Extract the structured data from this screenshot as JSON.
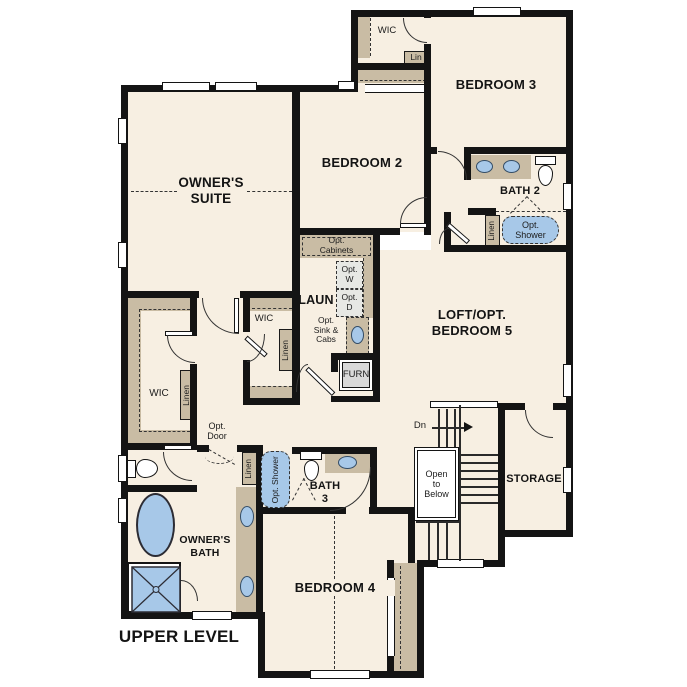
{
  "title": "UPPER LEVEL",
  "rooms": {
    "owners_suite": {
      "l1": "OWNER'S",
      "l2": "SUITE"
    },
    "bedroom2": "BEDROOM 2",
    "bedroom3": "BEDROOM 3",
    "bedroom4": "BEDROOM 4",
    "bedroom5_loft": {
      "l1": "LOFT/OPT.",
      "l2": "BEDROOM 5"
    },
    "bath2": "BATH 2",
    "bath3": {
      "l1": "BATH",
      "l2": "3"
    },
    "owners_bath": {
      "l1": "OWNER'S",
      "l2": "BATH"
    },
    "laundry": "LAUN",
    "storage": "STORAGE"
  },
  "closets": {
    "wic": "WIC",
    "lin": "Lin",
    "linen": "Linen"
  },
  "options": {
    "cabinets": {
      "l1": "Opt.",
      "l2": "Cabinets"
    },
    "washer": {
      "l1": "Opt.",
      "l2": "W"
    },
    "dryer": {
      "l1": "Opt.",
      "l2": "D"
    },
    "sink": {
      "l1": "Opt.",
      "l2": "Sink &",
      "l3": "Cabs"
    },
    "shower": {
      "l1": "Opt.",
      "l2": "Shower"
    },
    "door": {
      "l1": "Opt.",
      "l2": "Door"
    }
  },
  "equipment": {
    "furnace": "FURN"
  },
  "stairs": {
    "down": "Dn",
    "open_below": {
      "l1": "Open",
      "l2": "to",
      "l3": "Below"
    }
  },
  "colors": {
    "floor": "#f7efe2",
    "wall": "#141414",
    "cabinet": "#c9bca4",
    "fixture_blue": "#a7c8e8",
    "appliance_gray": "#e7e8e4"
  }
}
